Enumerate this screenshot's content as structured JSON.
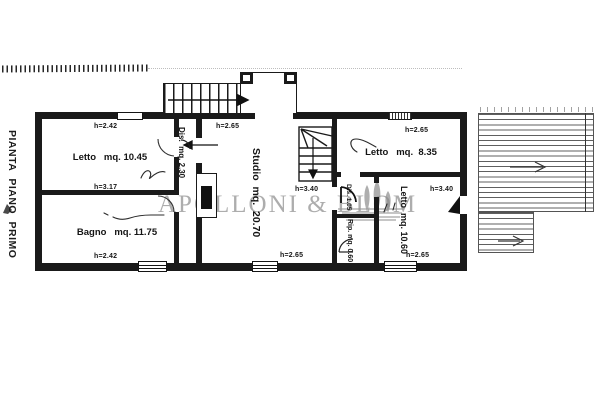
{
  "plan": {
    "title": "PIANTA PIANO PRIMO",
    "watermark": {
      "text": "APOLLONI & BLOM",
      "color": "#787878"
    },
    "ink_color": "#1a1a1a",
    "rooms": {
      "letto1": {
        "label": "Letto   mq. 10.45",
        "h_top": "h=2.42",
        "h_bottom": "h=3.17"
      },
      "bagno": {
        "label": "Bagno   mq. 11.75",
        "h_bottom": "h=2.42"
      },
      "dis1": {
        "label": "Dis.  mq. 2.30"
      },
      "studio": {
        "label": "Studio  mq.  20.70",
        "h_top": "h=2.65",
        "h_bottom": "h=2.65"
      },
      "letto2": {
        "label": "Letto   mq.  8.35",
        "h_top": "h=2.65"
      },
      "dis2": {
        "label": "Dis. 1.05"
      },
      "rip": {
        "label": "Rip. mq. 0.60"
      },
      "letto3": {
        "label": "Letto  mq. 10.60",
        "h_top": "h=3.40",
        "h_bottom": "h=2.65"
      }
    },
    "stairs_dim": "h=3.40"
  }
}
